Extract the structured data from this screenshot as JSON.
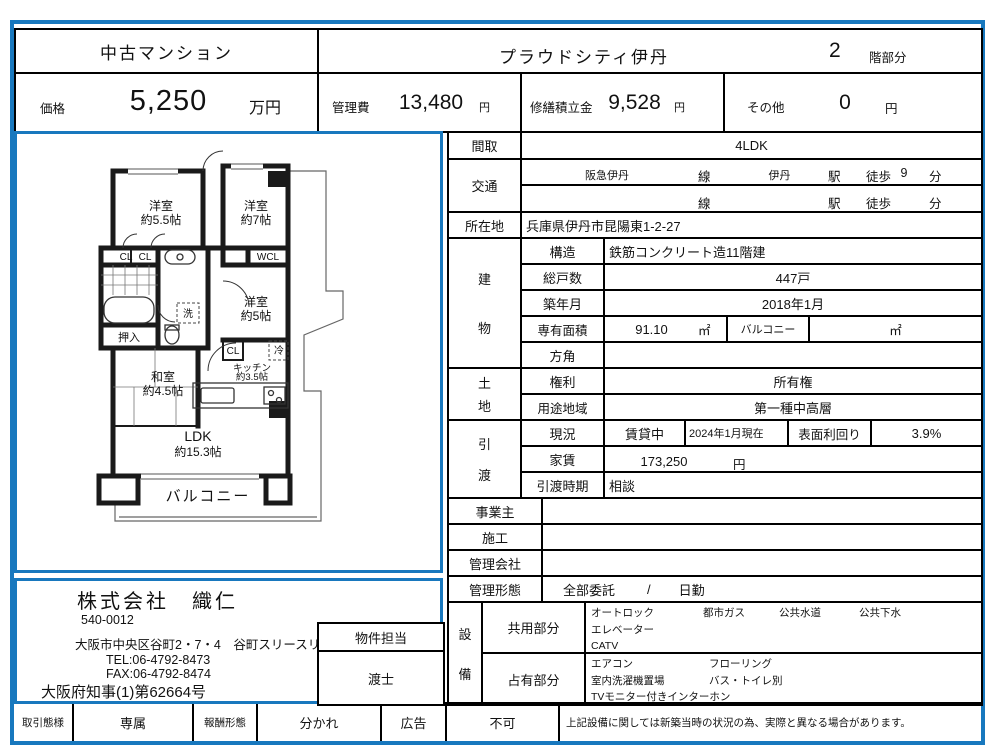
{
  "colors": {
    "frame_blue": "#1878be",
    "line_black": "#000000"
  },
  "header": {
    "property_type": "中古マンション",
    "property_name": "プラウドシティ伊丹",
    "floor_number": "2",
    "floor_suffix": "階部分",
    "price_label": "価格",
    "price_value": "5,250",
    "price_unit": "万円",
    "kanrihi_label": "管理費",
    "kanrihi_value": "13,480",
    "shuzen_label": "修繕積立金",
    "shuzen_value": "9,528",
    "sonota_label": "その他",
    "sonota_value": "0",
    "yen": "円"
  },
  "details": {
    "madori_label": "間取",
    "madori_value": "4LDK",
    "kotsu_label": "交通",
    "kotsu1": {
      "rail": "阪急伊丹",
      "sen": "線",
      "station": "伊丹",
      "eki": "駅",
      "toho": "徒歩",
      "min": "9",
      "fun": "分"
    },
    "kotsu2": {
      "rail": "",
      "sen": "線",
      "station": "",
      "eki": "駅",
      "toho": "徒歩",
      "min": "",
      "fun": "分"
    },
    "shozaichi_label": "所在地",
    "shozaichi_value": "兵庫県伊丹市昆陽東1-2-27",
    "tatemono_1": "建",
    "tatemono_2": "物",
    "kozo_label": "構造",
    "kozo_value": "鉄筋コンクリート造11階建",
    "sokosu_label": "総戸数",
    "sokosu_value": "447戸",
    "chiku_label": "築年月",
    "chiku_value": "2018年1月",
    "menseki_label": "専有面積",
    "menseki_value": "91.10",
    "menseki_unit": "㎡",
    "balcony_label": "バルコニー",
    "balcony_unit": "㎡",
    "hogaku_label": "方角",
    "tochi_1": "土",
    "tochi_2": "地",
    "kenri_label": "権利",
    "kenri_value": "所有権",
    "yoto_label": "用途地域",
    "yoto_value": "第一種中高層",
    "hikiwatashi_1": "引",
    "hikiwatashi_2": "渡",
    "genkyo_label": "現況",
    "genkyo_value": "賃貸中",
    "genkyo_asof": "2024年1月現在",
    "rimawari_label": "表面利回り",
    "rimawari_value": "3.9%",
    "yachin_label": "家賃",
    "yachin_value": "173,250",
    "yachin_unit": "円",
    "jiki_label": "引渡時期",
    "jiki_value": "相談",
    "jigyonushi_label": "事業主",
    "seko_label": "施工",
    "kanri_kaisha_label": "管理会社",
    "kanri_keitai_label": "管理形態",
    "kanri_keitai_v1": "全部委託",
    "kanri_keitai_slash": "/",
    "kanri_keitai_v2": "日勤",
    "setsubi_1": "設",
    "setsubi_2": "備",
    "kyoyo_label": "共用部分",
    "kyoyo_row1": [
      "オートロック",
      "都市ガス",
      "公共水道",
      "公共下水"
    ],
    "kyoyo_row2": "エレベーター",
    "kyoyo_row3": "CATV",
    "senyu_label": "占有部分",
    "senyu_row1": [
      "エアコン",
      "フローリング"
    ],
    "senyu_row2": [
      "室内洗濯機置場",
      "バス・トイレ別"
    ],
    "senyu_row3": "TVモニター付きインターホン"
  },
  "floorplan": {
    "caption": "現況と異なる場合は、現況を優先とします。",
    "labels": {
      "yoshitsu1a": "洋室",
      "yoshitsu1b": "約5.5帖",
      "yoshitsu2a": "洋室",
      "yoshitsu2b": "約7帖",
      "yoshitsu3a": "洋室",
      "yoshitsu3b": "約5帖",
      "washitsu_a": "和室",
      "washitsu_b": "約4.5帖",
      "ldk_a": "LDK",
      "ldk_b": "約15.3帖",
      "kitchen_a": "キッチン",
      "kitchen_b": "約3.5帖",
      "cl": "CL",
      "wcl": "WCL",
      "oshiire": "押入",
      "sen": "洗",
      "rei": "冷",
      "balcony": "バルコニー"
    }
  },
  "company": {
    "name": "株式会社　織仁",
    "postal": "540-0012",
    "address": "大阪市中央区谷町2・7・4　谷町スリースリーズビル３階",
    "tel": "TEL:06-4792-8473",
    "fax": "FAX:06-4792-8474",
    "license": "大阪府知事(1)第62664号",
    "staff_label": "物件担当",
    "staff_name": "渡士"
  },
  "bottom": {
    "torihiki_label": "取引態様",
    "torihiki_value": "専属",
    "hoshu_label": "報酬形態",
    "hoshu_value": "分かれ",
    "kokoku_label": "広告",
    "kokoku_value": "不可",
    "note": "上記設備に関しては新築当時の状況の為、実際と異なる場合があります。"
  }
}
